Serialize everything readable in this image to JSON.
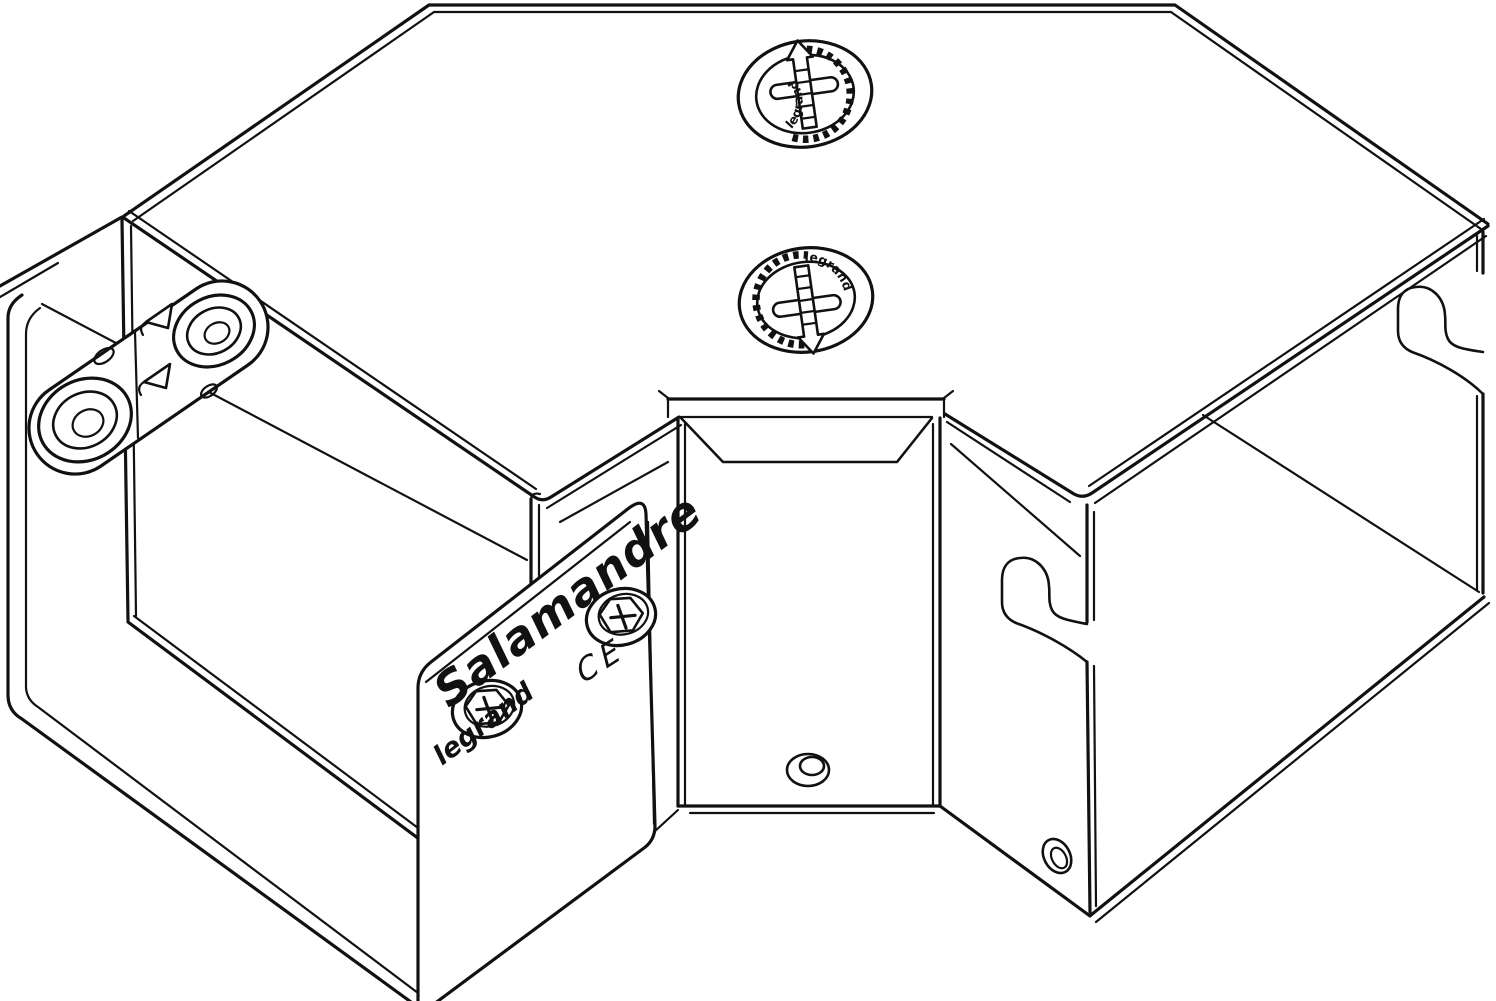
{
  "canvas": {
    "background": "#ffffff",
    "line_color": "#111111"
  },
  "lid_fasteners": [
    {
      "label": "legrand",
      "arrow": "up",
      "icon": "quarter-turn-fastener-icon"
    },
    {
      "label": "legrand",
      "arrow": "down",
      "icon": "quarter-turn-fastener-icon"
    }
  ],
  "plate": {
    "brand": "Salamandre",
    "ce_mark": "CE",
    "logo": "legrand"
  }
}
